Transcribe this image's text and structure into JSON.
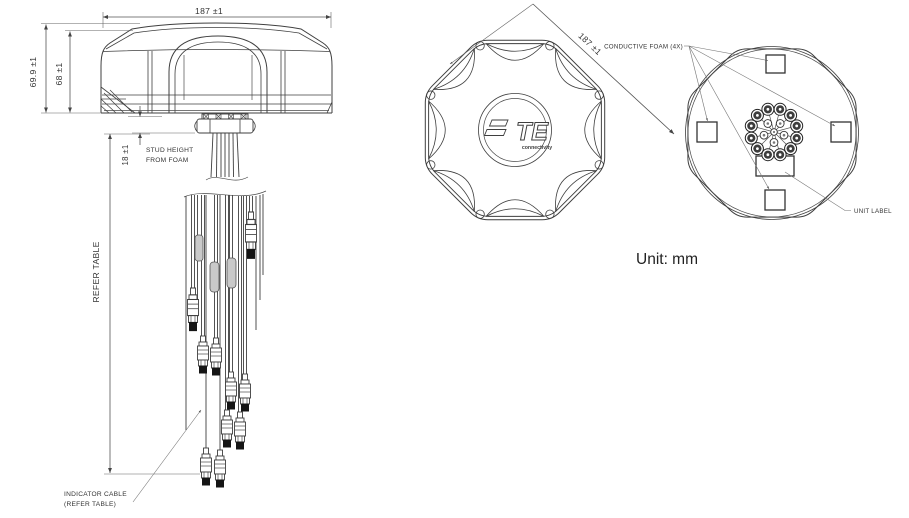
{
  "drawing": {
    "side_view": {
      "dim_width": "187 ±1",
      "dim_height_total": "69.9 ±1",
      "dim_height_body": "68 ±1",
      "dim_stud_height": "18 ±1",
      "stud_note_1": "STUD HEIGHT",
      "stud_note_2": "FROM FOAM",
      "cable_length_note": "REFER TABLE",
      "indicator_note_1": "INDICATOR CABLE",
      "indicator_note_2": "(REFER TABLE)"
    },
    "top_view": {
      "dim_width": "187 ±1",
      "logo": "TE",
      "logo_sub": "connectivity"
    },
    "bottom_view": {
      "foam_label": "CONDUCTIVE FOAM (4X)",
      "unit_label": "UNIT LABEL"
    },
    "units_note": "Unit: mm",
    "colors": {
      "line": "#3f3f3f",
      "text": "#333333",
      "background": "#ffffff"
    }
  }
}
